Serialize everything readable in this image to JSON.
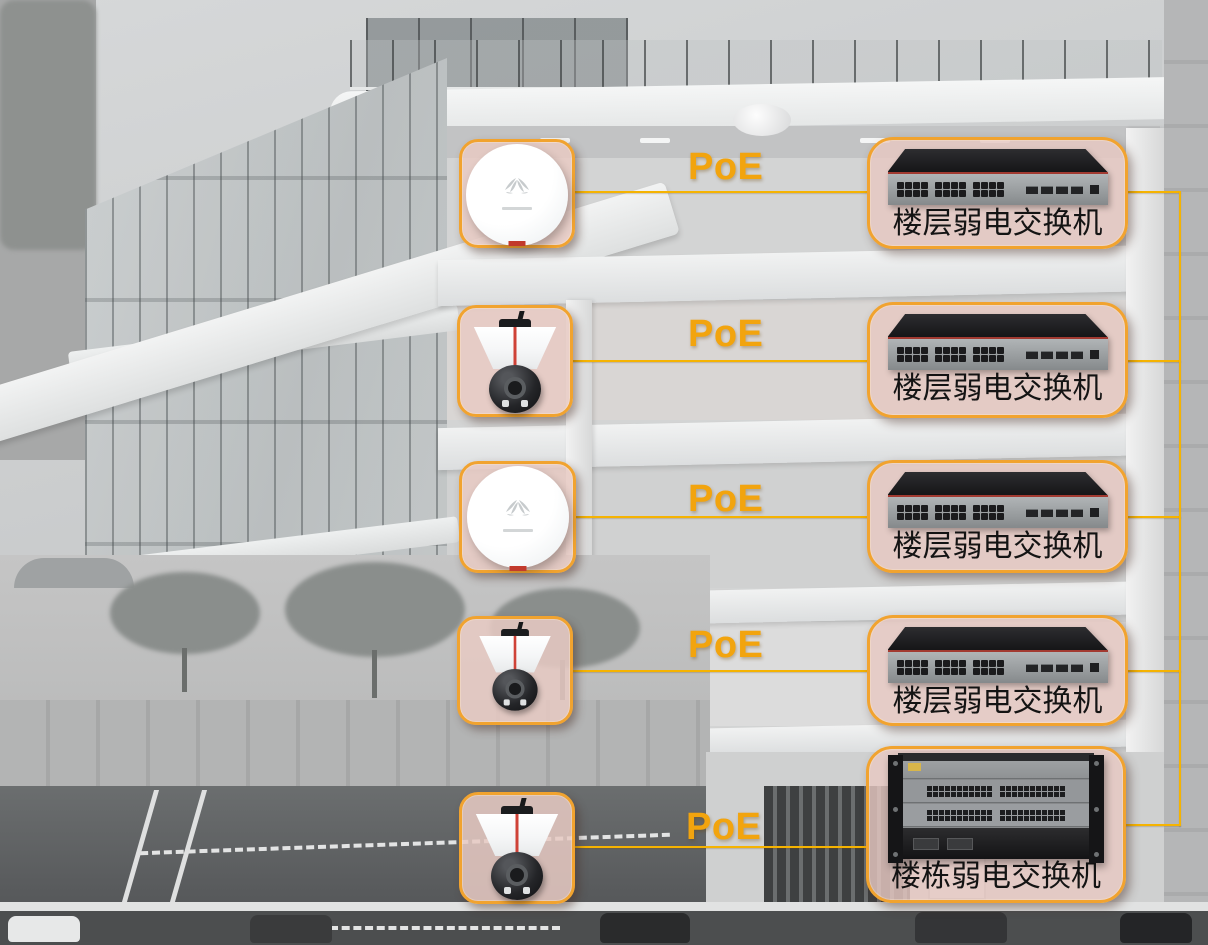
{
  "diagram_title": "Building PoE network topology over building cross-section",
  "poe_label": "PoE",
  "colors": {
    "accent_orange_text": "#F2A40E",
    "cable_yellow": "#F5B301",
    "box_border_orange": "#F1A32F",
    "box_fill_pink": "#E8CAC3"
  },
  "floors": [
    {
      "device": "wireless-ap",
      "poe_label": "PoE",
      "switch_label": "楼层弱电交换机",
      "switch_type": "floor-access-switch"
    },
    {
      "device": "ptz-camera",
      "poe_label": "PoE",
      "switch_label": "楼层弱电交换机",
      "switch_type": "floor-access-switch"
    },
    {
      "device": "wireless-ap",
      "poe_label": "PoE",
      "switch_label": "楼层弱电交换机",
      "switch_type": "floor-access-switch"
    },
    {
      "device": "ptz-camera",
      "poe_label": "PoE",
      "switch_label": "楼层弱电交换机",
      "switch_type": "floor-access-switch"
    },
    {
      "device": "ptz-camera",
      "poe_label": "PoE",
      "switch_label": "楼栋弱电交换机",
      "switch_type": "building-chassis-switch"
    }
  ]
}
